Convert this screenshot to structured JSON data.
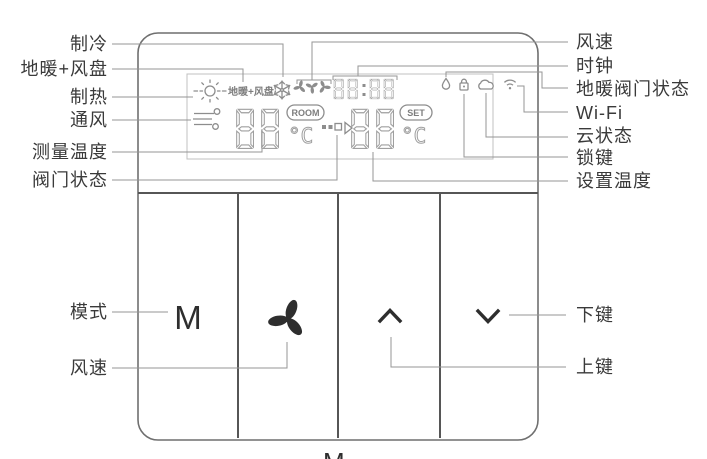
{
  "display": {
    "floorheat_fancoil": "地暖+风盘",
    "clock": "88:88",
    "room_value": "88",
    "room_label": "ROOM",
    "room_unit": "°C",
    "set_value": "88",
    "set_label": "SET",
    "set_unit": "°C"
  },
  "buttons": {
    "mode": "M"
  },
  "labels": {
    "cooling": "制冷",
    "floorheat_fancoil": "地暖+风盘",
    "heating": "制热",
    "ventilation": "通风",
    "measured_temp": "测量温度",
    "valve_status": "阀门状态",
    "fan_speed_display": "风速",
    "clock": "时钟",
    "floorheat_valve_status": "地暖阀门状态",
    "wifi": "Wi-Fi",
    "cloud_status": "云状态",
    "lock_key": "锁键",
    "set_temp": "设置温度",
    "mode_key": "模式",
    "fan_speed_key": "风速",
    "down_key": "下键",
    "up_key": "上键"
  },
  "footer_partial": "M",
  "colors": {
    "device_line": "#6f6f6f",
    "lcd_line": "#9f9f9f",
    "callout_line": "#959595",
    "label_text": "#3a3a3a",
    "button_glyph": "#2e2e2e",
    "background": "#ffffff"
  }
}
